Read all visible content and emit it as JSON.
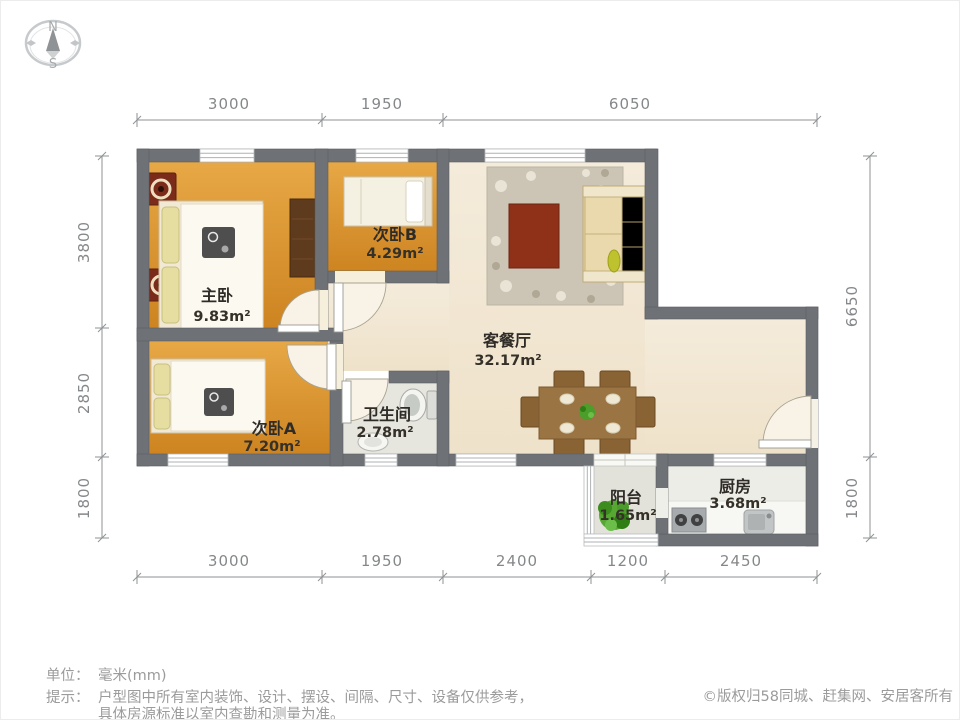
{
  "compass": {
    "north": "N",
    "south": "S"
  },
  "dimensions": {
    "unit": "mm",
    "top": [
      "3000",
      "1950",
      "6050"
    ],
    "bottom": [
      "3000",
      "1950",
      "2400",
      "1200",
      "2450"
    ],
    "left": [
      "3800",
      "2850",
      "1800"
    ],
    "right": [
      "6650",
      "1800"
    ]
  },
  "rooms": {
    "master_bedroom": {
      "name": "主卧",
      "area": "9.83m²"
    },
    "bedroom_b": {
      "name": "次卧B",
      "area": "4.29m²"
    },
    "bedroom_a": {
      "name": "次卧A",
      "area": "7.20m²"
    },
    "living_dining": {
      "name": "客餐厅",
      "area": "32.17m²"
    },
    "bathroom": {
      "name": "卫生间",
      "area": "2.78m²"
    },
    "balcony": {
      "name": "阳台",
      "area": "1.65m²"
    },
    "kitchen": {
      "name": "厨房",
      "area": "3.68m²"
    }
  },
  "footer": {
    "unit_label": "单位：",
    "unit_value": "毫米(mm)",
    "tip_label": "提示：",
    "tip_line1": "户型图中所有室内装饰、设计、摆设、间隔、尺寸、设备仅供参考，",
    "tip_line2": "具体房源标准以室内查勘和测量为准。",
    "copyright": "©版权归58同城、赶集网、安居客所有"
  },
  "colors": {
    "wall": "#6e7276",
    "bedroom_floor": "#dc9a33",
    "living_floor": "#f2e9d6",
    "bathroom_floor": "#e6e6df",
    "kitchen_floor": "#ededE8",
    "coffee_table": "#8f3018",
    "sofa": "#e3d1a0",
    "dining_wood": "#9a7442",
    "plant_green": "#4c9e2a",
    "rug_accent": "#7b2b1a"
  }
}
